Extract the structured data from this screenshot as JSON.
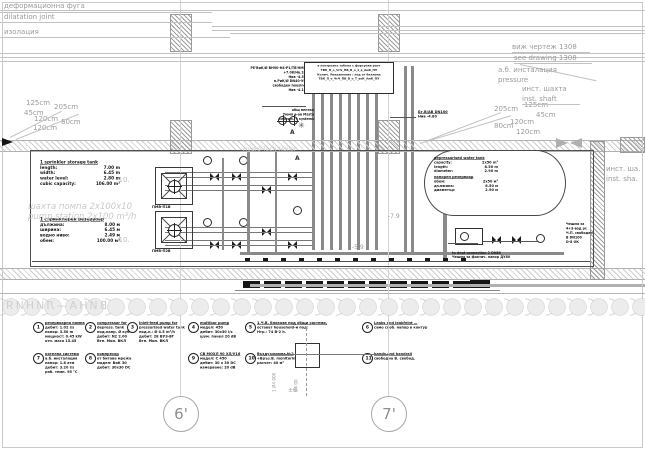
{
  "drawing": {
    "axes": {
      "axis1": "6'",
      "axis2": "7'"
    },
    "top_left": {
      "l1": "деформационна фуга",
      "l2": "dilatation joint",
      "l3": "изолация"
    },
    "top_right": {
      "l1": "виж чертеж 1308",
      "l2": "see drawing 1308",
      "l3": "а.б. инсталация",
      "l4": "pressure",
      "l5": "инст. шахта",
      "l6": "inst. shaft"
    },
    "right_edge": {
      "l1": "инст. ша.",
      "l2": "inst. sha."
    },
    "dims_left": [
      "125cm",
      "205cm",
      "45cm",
      "120cm",
      "80cm",
      "120cm"
    ],
    "dims_right": [
      "205cm",
      "125cm",
      "45cm",
      "120cm",
      "80cm",
      "120cm"
    ],
    "storage_tank_en": {
      "title": "1 sprinkler storage tank",
      "rows": [
        [
          "length:",
          "7.00 m"
        ],
        [
          "width:",
          "6.45 m"
        ],
        [
          "water level:",
          "2.80 m"
        ],
        [
          "cubic capacity:",
          "106.00 m³"
        ]
      ]
    },
    "storage_tank_bg": {
      "title": "1 спринклерен резервоар",
      "rows": [
        [
          "дължина:",
          "8.00 м"
        ],
        [
          "ширина:",
          "6.45 м"
        ],
        [
          "водно ниво:",
          "2.49 м"
        ],
        [
          "обем:",
          "100.00 м³"
        ]
      ]
    },
    "pump_shaft_watermark": {
      "l1": "шахта помпа 2x100x10",
      "l2": "pump station 2x100 m³/h"
    },
    "level_marks": {
      "m1": "-10.",
      "m2": "-10."
    },
    "pit_labels": {
      "p1": "ПМВ-П1В",
      "p2": "ПМВ-П2В"
    },
    "pressure_tank": {
      "title_en": "depressurised water tank",
      "rows_en": [
        [
          "capacity:",
          "2x50 m³"
        ],
        [
          "length:",
          "8.50 m"
        ],
        [
          "diameter:",
          "2.90 m"
        ]
      ],
      "title_bg": "напорен резервоар",
      "rows_bg": [
        [
          "обем:",
          "2x50 м³"
        ],
        [
          "дължина:",
          "8.50 м"
        ],
        [
          "диаметър:",
          "2.90 м"
        ]
      ]
    },
    "pipe_riser_labels": {
      "lines": [
        "РЕ'ВиК/Ø ВН90-Н4-Р1/ТВ'НМВ",
        "+7.08/Нв.1В",
        "Нив -4.55",
        "в.РиК/Ø DN40-УВ",
        "свободен housing",
        "Нив -4.15"
      ],
      "lines2": [
        "общ вентил",
        "Тюмп в-ов Мssta",
        "середн. + systems"
      ]
    },
    "legend_box": {
      "rows": [
        "в контролна табела с форсунки расч",
        "ТВК_П_о_ЧгЧ_ПВ_В_о_1_в_АмК_ПУ",
        "Колич. Увлажнение / ход от баллона",
        "ТВК_П_о_ЧгЧ_ПВ_В_о_Т_веК_АмК_ПУ"
      ]
    },
    "right_pipe_label": {
      "l1": "Бт.В/АВ DN100",
      "l2": "Нив -4.80"
    },
    "hydro_label": "Hydro-Tech-Holler",
    "section_a1": "A",
    "section_a2": "A",
    "floor_label": {
      "l1": "to dept connection 2 DN80",
      "l2": "Чешма за фактич. напор ДУ80"
    },
    "right_block": {
      "lines": [
        "Чешма за",
        "4+3-вод pr.",
        "Ч.П. свободен",
        "В DN100",
        "D-8 ОК"
      ]
    },
    "misc": {
      "m79": "-7.9",
      "m59": "-5.9",
      "pz": "±0",
      "v1": "1 Ø4 000",
      "v2": "Ø4 00",
      "star": "✳"
    },
    "band_watermark": "ВИНА—ЛИНИЯ",
    "notes": [
      {
        "num": "1",
        "lines": [
          "резервоарна помпа",
          "дебит:  1.02 l/s",
          "напор:  3.50 m",
          "мощност: 0.45 kW",
          "отн. маса 15.45"
        ]
      },
      {
        "num": "2",
        "lines": [
          "compressor for",
          "depress. tank",
          "под.напр. Ø куб",
          "дебит: N2 2.00",
          "Втп. Мин. ВКЛ"
        ]
      },
      {
        "num": "3",
        "lines": [
          "Inlet-feed pump for",
          "pressurised water tank",
          "под.н.: Ø 4.5 m³/h",
          "дебит: 28 ВУЗ-ВГ",
          "Втп. Мин. ВКЛ"
        ]
      },
      {
        "num": "4",
        "lines": [
          "multibar pump",
          "модел: 450",
          "дебит: 30x30 l/s",
          "шум. панел 20 dB"
        ]
      },
      {
        "num": "5",
        "lines": [
          "1.Ч.В. блокове под общи системи,",
          "остават household-и под:",
          "Нтр.: 74 В-2 h."
        ]
      },
      {
        "num": "6",
        "lines": [
          "Leaks and leakfeint —",
          "само своб. напор в контур"
        ]
      },
      {
        "num": "7",
        "lines": [
          "котелна система",
          "а.б. инсталация",
          "напор: 1.8 атм",
          "дебит: 3.20 l/s",
          "раб. темп. 95 °С"
        ]
      },
      {
        "num": "8",
        "lines": [
          "компресор",
          "от битова мрежа",
          "модел: ВиК 30",
          "дебит: 30x30 DC"
        ]
      },
      {
        "num": "9",
        "lines": [
          "СВ МОХЛ 90 ХЛ/У16",
          "модел: С 450",
          "дебит: 30 x 30 DC",
          "измерване: 20 dB"
        ]
      },
      {
        "num": "10",
        "lines": [
          "Въздух-помпа Н-2",
          "+Връз.В. monitoring",
          "расчет: 40 м³"
        ]
      },
      {
        "num": "11",
        "lines": [
          "hands and handrail",
          "свободна В. свобод."
        ]
      }
    ]
  }
}
